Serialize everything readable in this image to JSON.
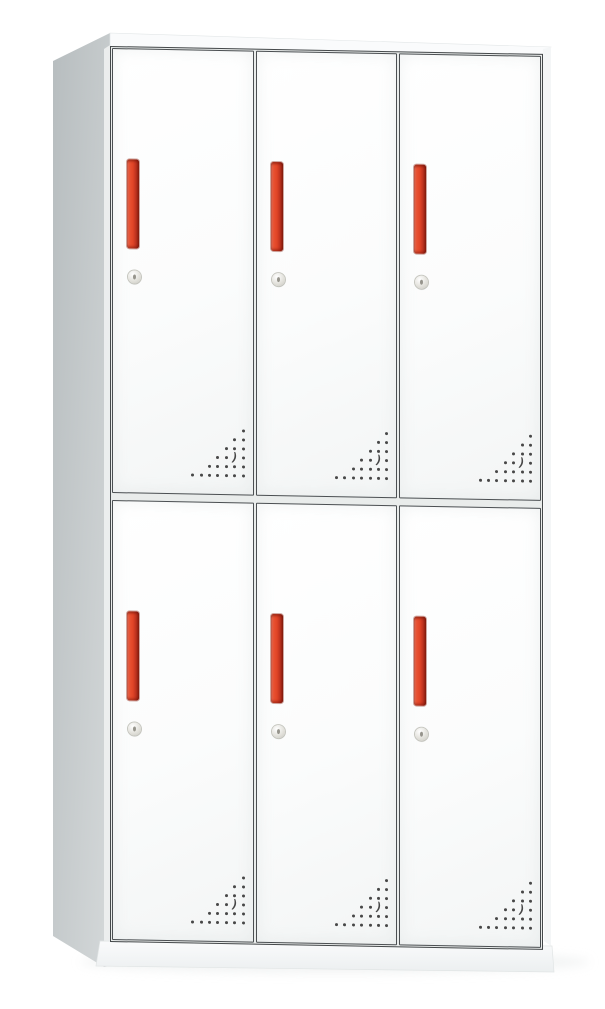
{
  "image": {
    "type": "product-photo",
    "subject": "White steel locker cabinet with six doors, red vertical handles, round key locks and triangular ventilation hole patterns",
    "cabinet": {
      "rows": 2,
      "columns": 3,
      "door_count": 6,
      "row_names": [
        "top",
        "bottom"
      ],
      "column_names": [
        "left",
        "middle",
        "right"
      ],
      "door_features": [
        "vertical red pull handle",
        "round key lock below handle",
        "triangular pattern of vent holes at bottom-right corner"
      ],
      "vent_rows": [
        [
          0
        ],
        [
          0,
          1
        ],
        [
          0,
          1,
          2
        ],
        [
          0,
          2,
          3
        ],
        [
          0,
          1,
          2,
          3,
          4
        ],
        [
          0,
          1,
          2,
          3,
          4,
          5,
          6
        ]
      ],
      "vent_curve": {
        "row": 3,
        "col": 1,
        "glyph": ")"
      }
    },
    "colors": {
      "background": "#ffffff",
      "door_face": "#fbfcfc",
      "frame_line": "#45494b",
      "frame_gap": "#e9eceb",
      "side_panel_dark": "#b7bdbf",
      "side_panel_light": "#d4d8d9",
      "top_surface": "#fafbfc",
      "base": "#f6f8f8",
      "handle_highlight": "#f0826a",
      "handle_red": "#e04426",
      "handle_shadow": "#8c2010",
      "lock_silver": "#e3e2dc",
      "vent_dot": "#474747"
    }
  }
}
